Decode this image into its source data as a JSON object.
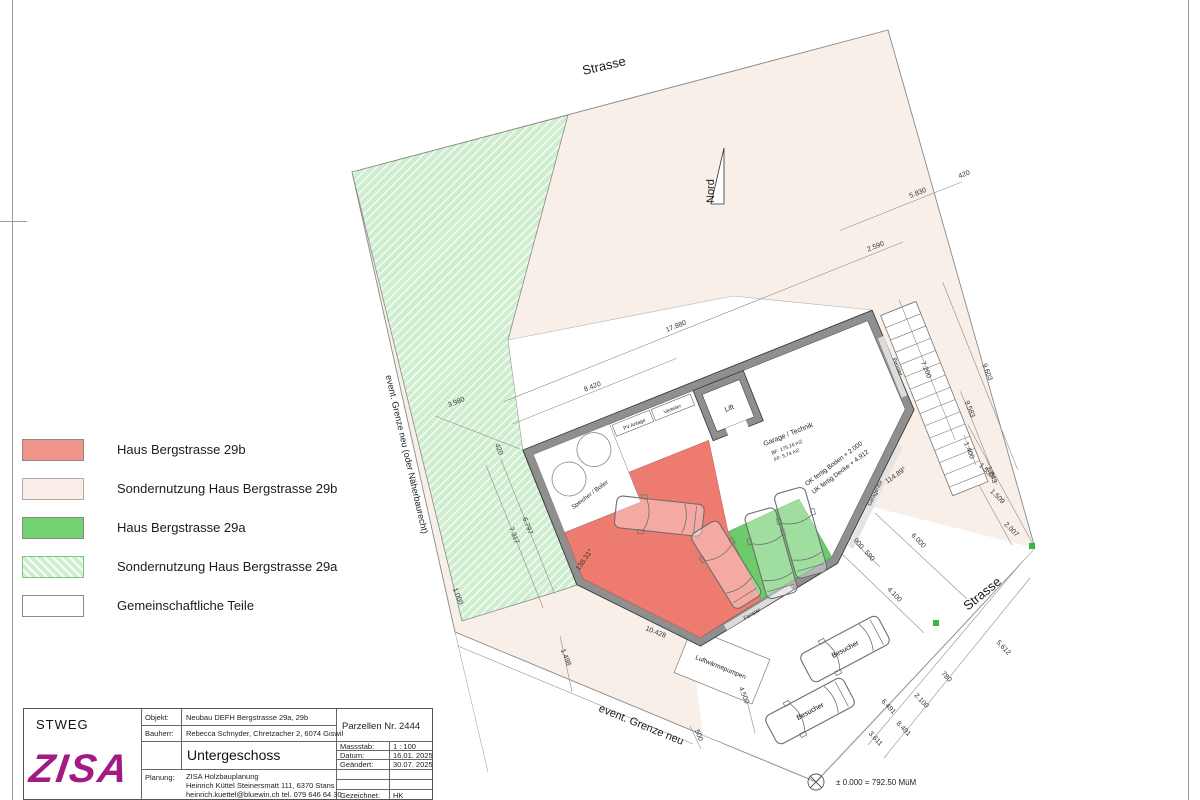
{
  "legend": {
    "items": [
      {
        "label": "Haus  Bergstrasse 29b",
        "style": "sw-red"
      },
      {
        "label": "Sondernutzung Haus  Bergstrasse 29b",
        "style": "sw-pink"
      },
      {
        "label": "Haus  Bergstrasse 29a",
        "style": "sw-green"
      },
      {
        "label": "Sondernutzung Haus Bergstrasse 29a",
        "style": "sw-hatch"
      },
      {
        "label": "Gemeinschaftliche Teile",
        "style": "sw-white"
      }
    ]
  },
  "titleblock": {
    "org": "STWEG",
    "logo": "ZISA",
    "objekt_label": "Objekt:",
    "objekt": "Neubau DEFH Bergstrasse 29a, 29b",
    "bauherr_label": "Bauherr:",
    "bauherr": "Rebecca Schnyder,   Chretzacher 2,   6074 Giswil",
    "parzelle": "Parzellen Nr. 2444",
    "plan_title": "Untergeschoss",
    "massstab_label": "Massstab:",
    "massstab": "1 : 100",
    "datum_label": "Datum:",
    "datum": "16.01. 2025",
    "geaendert_label": "Geändert:",
    "geaendert": "30.07. 2025",
    "planung_label": "Planung:",
    "planung1": "ZISA Holzbauplanung",
    "planung2": "Heinrich Küttel Steinersmatt 111,   6370 Stans",
    "planung3": "heinrich.kuettel@bluewin.ch   tel. 079 646 64 30",
    "gezeichnet_label": "Gezeichnet:",
    "gezeichnet": "HK"
  },
  "colors": {
    "red_zone": "#ee7b70",
    "green_zone": "#6ccc6c",
    "pink_parcel": "#f7efe8",
    "hatch_green_base": "#cfeecf",
    "wall_gray": "#8f8f8f",
    "logo_magenta": "#a21a84",
    "marker_green": "#3db53d"
  },
  "plan": {
    "screen_labels": [
      {
        "text": "Strasse",
        "x": 605,
        "y": 70,
        "rot": -13,
        "size": 13,
        "name": "street-label-top"
      },
      {
        "text": "Strasse",
        "x": 985,
        "y": 597,
        "rot": -39,
        "size": 13,
        "name": "street-label-right"
      },
      {
        "text": "Nord",
        "x": 714,
        "y": 203,
        "rot": -90,
        "size": 11,
        "anchor": "start",
        "name": "north-label"
      },
      {
        "text": "event. Grenze neu (oder Näherbaurecht)",
        "x": 404,
        "y": 455,
        "rot": 77,
        "size": 9,
        "name": "boundary-label-left"
      },
      {
        "text": "event. Grenze neu",
        "x": 640,
        "y": 728,
        "rot": 22,
        "size": 11,
        "name": "boundary-label-bottom"
      },
      {
        "text": "Luftwärmepumpen",
        "x": 720,
        "y": 669,
        "rot": 22,
        "size": 6.5,
        "name": "heatpump-label"
      },
      {
        "text": "± 0.000 = 792.50 MüM",
        "x": 836,
        "y": 785,
        "rot": 0,
        "size": 8,
        "anchor": "start",
        "name": "benchmark-label"
      }
    ],
    "screen_dims": [
      {
        "text": "3.980",
        "x": 457,
        "y": 404,
        "rot": -22
      },
      {
        "text": "420",
        "x": 497,
        "y": 450,
        "rot": 68
      },
      {
        "text": "1.000",
        "x": 456,
        "y": 597,
        "rot": 68
      },
      {
        "text": "10.428",
        "x": 655,
        "y": 634,
        "rot": 22
      },
      {
        "text": "1.498",
        "x": 564,
        "y": 658,
        "rot": 68
      },
      {
        "text": "4.500",
        "x": 742,
        "y": 696,
        "rot": 68
      },
      {
        "text": "500",
        "x": 697,
        "y": 736,
        "rot": 68
      },
      {
        "text": "900",
        "x": 857,
        "y": 545,
        "rot": 48
      },
      {
        "text": "590",
        "x": 868,
        "y": 557,
        "rot": 48
      },
      {
        "text": "6.000",
        "x": 917,
        "y": 542,
        "rot": 46
      },
      {
        "text": "4.100",
        "x": 893,
        "y": 596,
        "rot": 46
      },
      {
        "text": "5.612",
        "x": 1002,
        "y": 649,
        "rot": 47
      },
      {
        "text": "780",
        "x": 945,
        "y": 678,
        "rot": 47
      },
      {
        "text": "2.100",
        "x": 920,
        "y": 702,
        "rot": 47
      },
      {
        "text": "6.491",
        "x": 887,
        "y": 708,
        "rot": 47
      },
      {
        "text": "8.491",
        "x": 902,
        "y": 730,
        "rot": 47
      },
      {
        "text": "3.611",
        "x": 874,
        "y": 740,
        "rot": 47
      },
      {
        "text": "1.550",
        "x": 985,
        "y": 472,
        "rot": 45
      },
      {
        "text": "1.509",
        "x": 996,
        "y": 498,
        "rot": 45
      },
      {
        "text": "2.007",
        "x": 1010,
        "y": 531,
        "rot": 45
      },
      {
        "text": "114.89°",
        "x": 897,
        "y": 477,
        "rot": -35
      },
      {
        "text": "138.31°",
        "x": 586,
        "y": 561,
        "rot": -55
      }
    ],
    "local_labels": [
      {
        "text": "Lift",
        "x": 207,
        "y": 40,
        "size": 7,
        "name": "lift-label"
      },
      {
        "text": "PV Anlage",
        "x": 113,
        "y": 19,
        "size": 5,
        "name": "pv-label"
      },
      {
        "text": "Verteiler",
        "x": 154,
        "y": 19,
        "size": 5,
        "name": "verteiler-label"
      },
      {
        "text": "Speicher / Boiler",
        "x": 46,
        "y": 68,
        "rot": -15,
        "size": 6,
        "name": "boiler-label"
      },
      {
        "text": "Garage / Technik",
        "x": 252,
        "y": 86,
        "size": 7,
        "name": "garage-label"
      },
      {
        "text": "BF: 175,16 m2",
        "x": 246,
        "y": 97,
        "size": 5
      },
      {
        "text": "FF: 5,74 m2",
        "x": 243,
        "y": 104,
        "size": 5
      },
      {
        "text": "OK fertig Boden + 2.000",
        "x": 284,
        "y": 130,
        "rot": -15,
        "size": 6.5
      },
      {
        "text": "UK fertig Decke + 4.912",
        "x": 287,
        "y": 140,
        "rot": -15,
        "size": 6.5
      },
      {
        "text": "Fenster",
        "x": 152,
        "y": 239,
        "rot": -9,
        "size": 5.5,
        "name": "window-label"
      },
      {
        "text": "Garagentor",
        "x": 312,
        "y": 172,
        "rot": -42,
        "size": 5.5,
        "name": "garagedoor-label"
      },
      {
        "text": "Fenster",
        "x": 377,
        "y": 62,
        "rot": 90,
        "size": 5.5,
        "name": "window-label"
      }
    ],
    "local_dims": [
      {
        "text": "8.420",
        "x": 88,
        "y": -31
      },
      {
        "text": "17.880",
        "x": 188,
        "y": -56
      },
      {
        "text": "2.590",
        "x": 403,
        "y": -56
      },
      {
        "text": "5.830",
        "x": 462,
        "y": -90
      },
      {
        "text": "420",
        "x": 512,
        "y": -90
      },
      {
        "text": "7.200",
        "x": 402,
        "y": 75,
        "rot": 90
      },
      {
        "text": "9.603",
        "x": 458,
        "y": 100,
        "rot": 90
      },
      {
        "text": "9.583",
        "x": 428,
        "y": 128,
        "rot": 90
      },
      {
        "text": "1.400",
        "x": 412,
        "y": 166,
        "rot": 90
      },
      {
        "text": "1.043",
        "x": 424,
        "y": 197,
        "rot": 90
      },
      {
        "text": "6.797",
        "x": -26,
        "y": 72,
        "rot": 90
      },
      {
        "text": "7.317",
        "x": -42,
        "y": 76,
        "rot": 90
      }
    ],
    "cars_local": [
      {
        "x": 102,
        "y": 112,
        "rot": 28
      },
      {
        "x": 146,
        "y": 182,
        "rot": 80
      },
      {
        "x": 192,
        "y": 188,
        "rot": 96
      },
      {
        "x": 227,
        "y": 180,
        "rot": 96
      }
    ],
    "cars_screen": [
      {
        "x": 845,
        "y": 649,
        "rot": -28,
        "label": "Besucher"
      },
      {
        "x": 810,
        "y": 711,
        "rot": -28,
        "label": "Besucher"
      }
    ],
    "north_label": "Nord"
  }
}
